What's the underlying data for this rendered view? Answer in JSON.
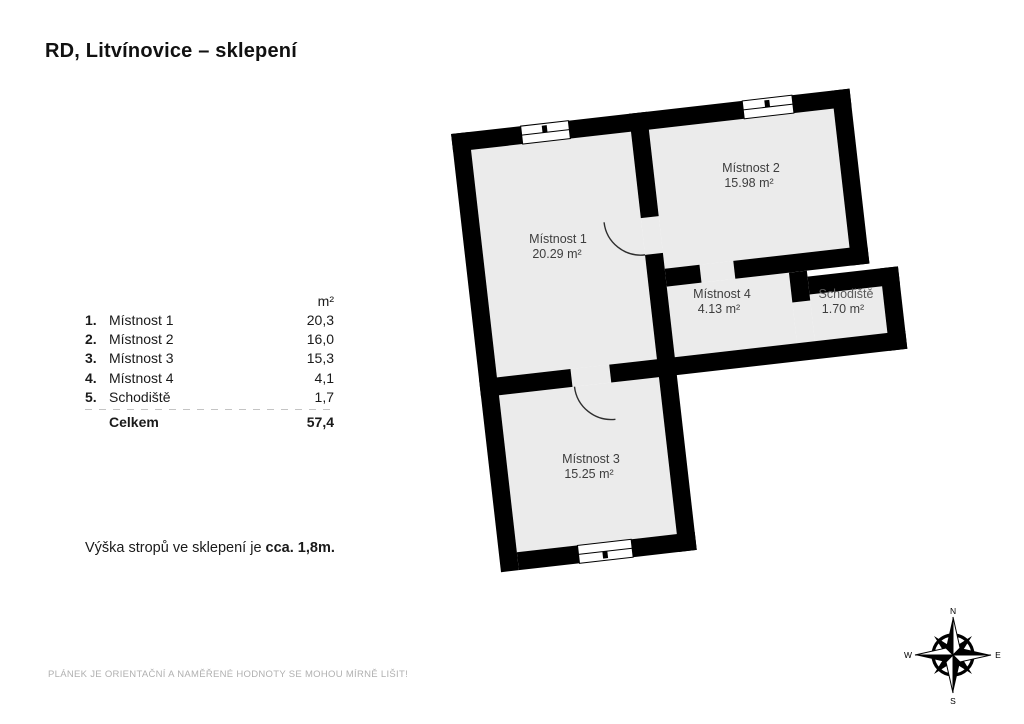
{
  "title": "RD, Litvínovice – sklepení",
  "legend": {
    "unit_header": "m²",
    "rows": [
      {
        "num": "1.",
        "label": "Místnost 1",
        "value": "20,3"
      },
      {
        "num": "2.",
        "label": "Místnost 2",
        "value": "16,0"
      },
      {
        "num": "3.",
        "label": "Místnost 3",
        "value": "15,3"
      },
      {
        "num": "4.",
        "label": "Místnost 4",
        "value": "4,1"
      },
      {
        "num": "5.",
        "label": "Schodiště",
        "value": "1,7"
      }
    ],
    "total_label": "Celkem",
    "total_value": "57,4"
  },
  "note": {
    "prefix": "Výška stropů ve sklepení je ",
    "bold": "cca. 1,8m."
  },
  "disclaimer": "PLÁNEK JE ORIENTAČNÍ A NAMĚŘENÉ HODNOTY SE MOHOU MÍRNĚ LIŠIT!",
  "plan": {
    "rooms": [
      {
        "name": "Místnost 1",
        "area": "20.29 m²"
      },
      {
        "name": "Místnost 2",
        "area": "15.98 m²"
      },
      {
        "name": "Místnost 3",
        "area": "15.25 m²"
      },
      {
        "name": "Místnost 4",
        "area": "4.13 m²"
      },
      {
        "name": "Schodiště",
        "area": "1.70 m²"
      }
    ],
    "rotation_deg": -6.5,
    "colors": {
      "wall": "#000000",
      "room_fill": "#ebebeb",
      "label": "#3e3e3e"
    }
  },
  "compass": {
    "directions": [
      "N",
      "E",
      "S",
      "W"
    ]
  }
}
